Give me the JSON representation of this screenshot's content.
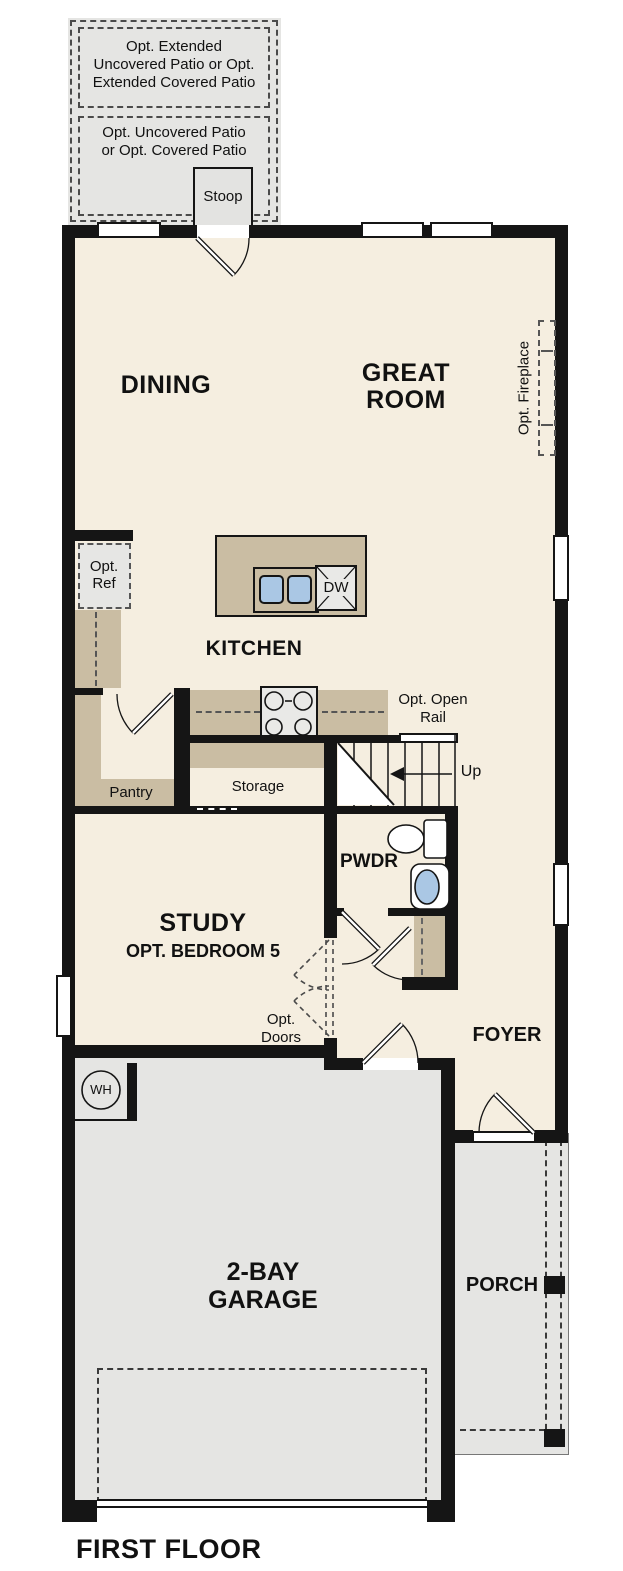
{
  "title": "FIRST FLOOR",
  "colors": {
    "floor": "#f5eee0",
    "hardscape": "#e5e5e3",
    "counter": "#cabda3",
    "wall": "#151515",
    "water": "#aac7e4"
  },
  "outdoor": {
    "extended_patio": "Opt. Extended\nUncovered Patio or Opt.\nExtended Covered Patio",
    "patio": "Opt. Uncovered Patio\nor Opt. Covered Patio",
    "stoop": "Stoop",
    "porch": "PORCH"
  },
  "rooms": {
    "dining": "DINING",
    "great_room": "GREAT\nROOM",
    "kitchen": "KITCHEN",
    "pantry": "Pantry",
    "storage": "Storage",
    "powder": "PWDR",
    "study": "STUDY",
    "study_option": "OPT. BEDROOM 5",
    "foyer": "FOYER",
    "garage": "2-BAY\nGARAGE"
  },
  "annotations": {
    "fireplace": "Opt. Fireplace",
    "refrigerator": "Opt.\nRef",
    "dishwasher": "DW",
    "open_rail": "Opt. Open\nRail",
    "stairs_up": "Up",
    "optional_doors": "Opt.\nDoors",
    "water_heater": "WH"
  }
}
